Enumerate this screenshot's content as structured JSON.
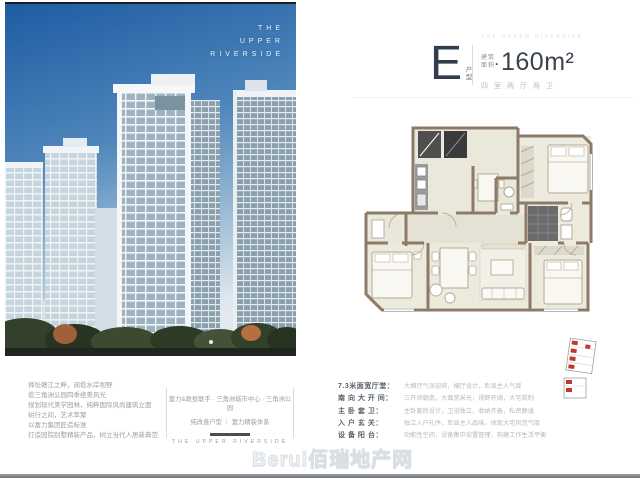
{
  "brand": {
    "vertical": [
      "THE",
      "UPPER",
      "RIVERSIDE"
    ],
    "footer": "THE UPPER RIVERSIDE"
  },
  "unit_header": {
    "letter": "E",
    "letter_suffix": "户型",
    "mini_brand": "THE UPPER RIVERSIDE",
    "area_label_top": "建筑",
    "area_label_bottom": "面积",
    "area_separator": "·",
    "area_value": "160m²",
    "layout_summary": "四室两厅两卫"
  },
  "left_copy": {
    "lines": [
      "择址赣江之畔，阅揽水岸视野",
      "揽三角洲公园四季绝美风光",
      "规划现代美学园林，纯粹国际风尚建筑立面",
      "树行之间，艺术萃聚",
      "以富力集团匠造标准",
      "打造园院别墅精装产品，树立当代人居新典范"
    ]
  },
  "center_block": {
    "line1": "富力&政投联手 · 三角洲城市中心 · 三角洲公园",
    "line2": "纯改善户型 ｜ 富力精装体系",
    "brand_footer": "THE UPPER RIVERSIDE"
  },
  "features": {
    "rows": [
      {
        "label": "7.3米面宽厅堂：",
        "desc": "大横厅气派迎宾，横厅设计，彰显主人气度"
      },
      {
        "label": "南 向 大 开 间：",
        "desc": "三开间朝南，大面宽采光，视野开阔，大宅规制"
      },
      {
        "label": "主 卧 套 卫：",
        "desc": "主卧套房设计，卫浴独立，收纳齐备，私密静谧"
      },
      {
        "label": "入 户 玄 关：",
        "desc": "独立入户礼序，彰显主人品味，体现大宅风范气度"
      },
      {
        "label": "设 备 阳 台：",
        "desc": "功能性空间，设备集中安置管理，构建工作生活平衡"
      }
    ]
  },
  "watermark": {
    "text": "Berui佰瑞地产网"
  },
  "colors": {
    "accent_dark": "#2f3d4c",
    "wall": "#8d7a68",
    "key_red": "#c0392b",
    "sky_top": "#1e5ca3"
  }
}
